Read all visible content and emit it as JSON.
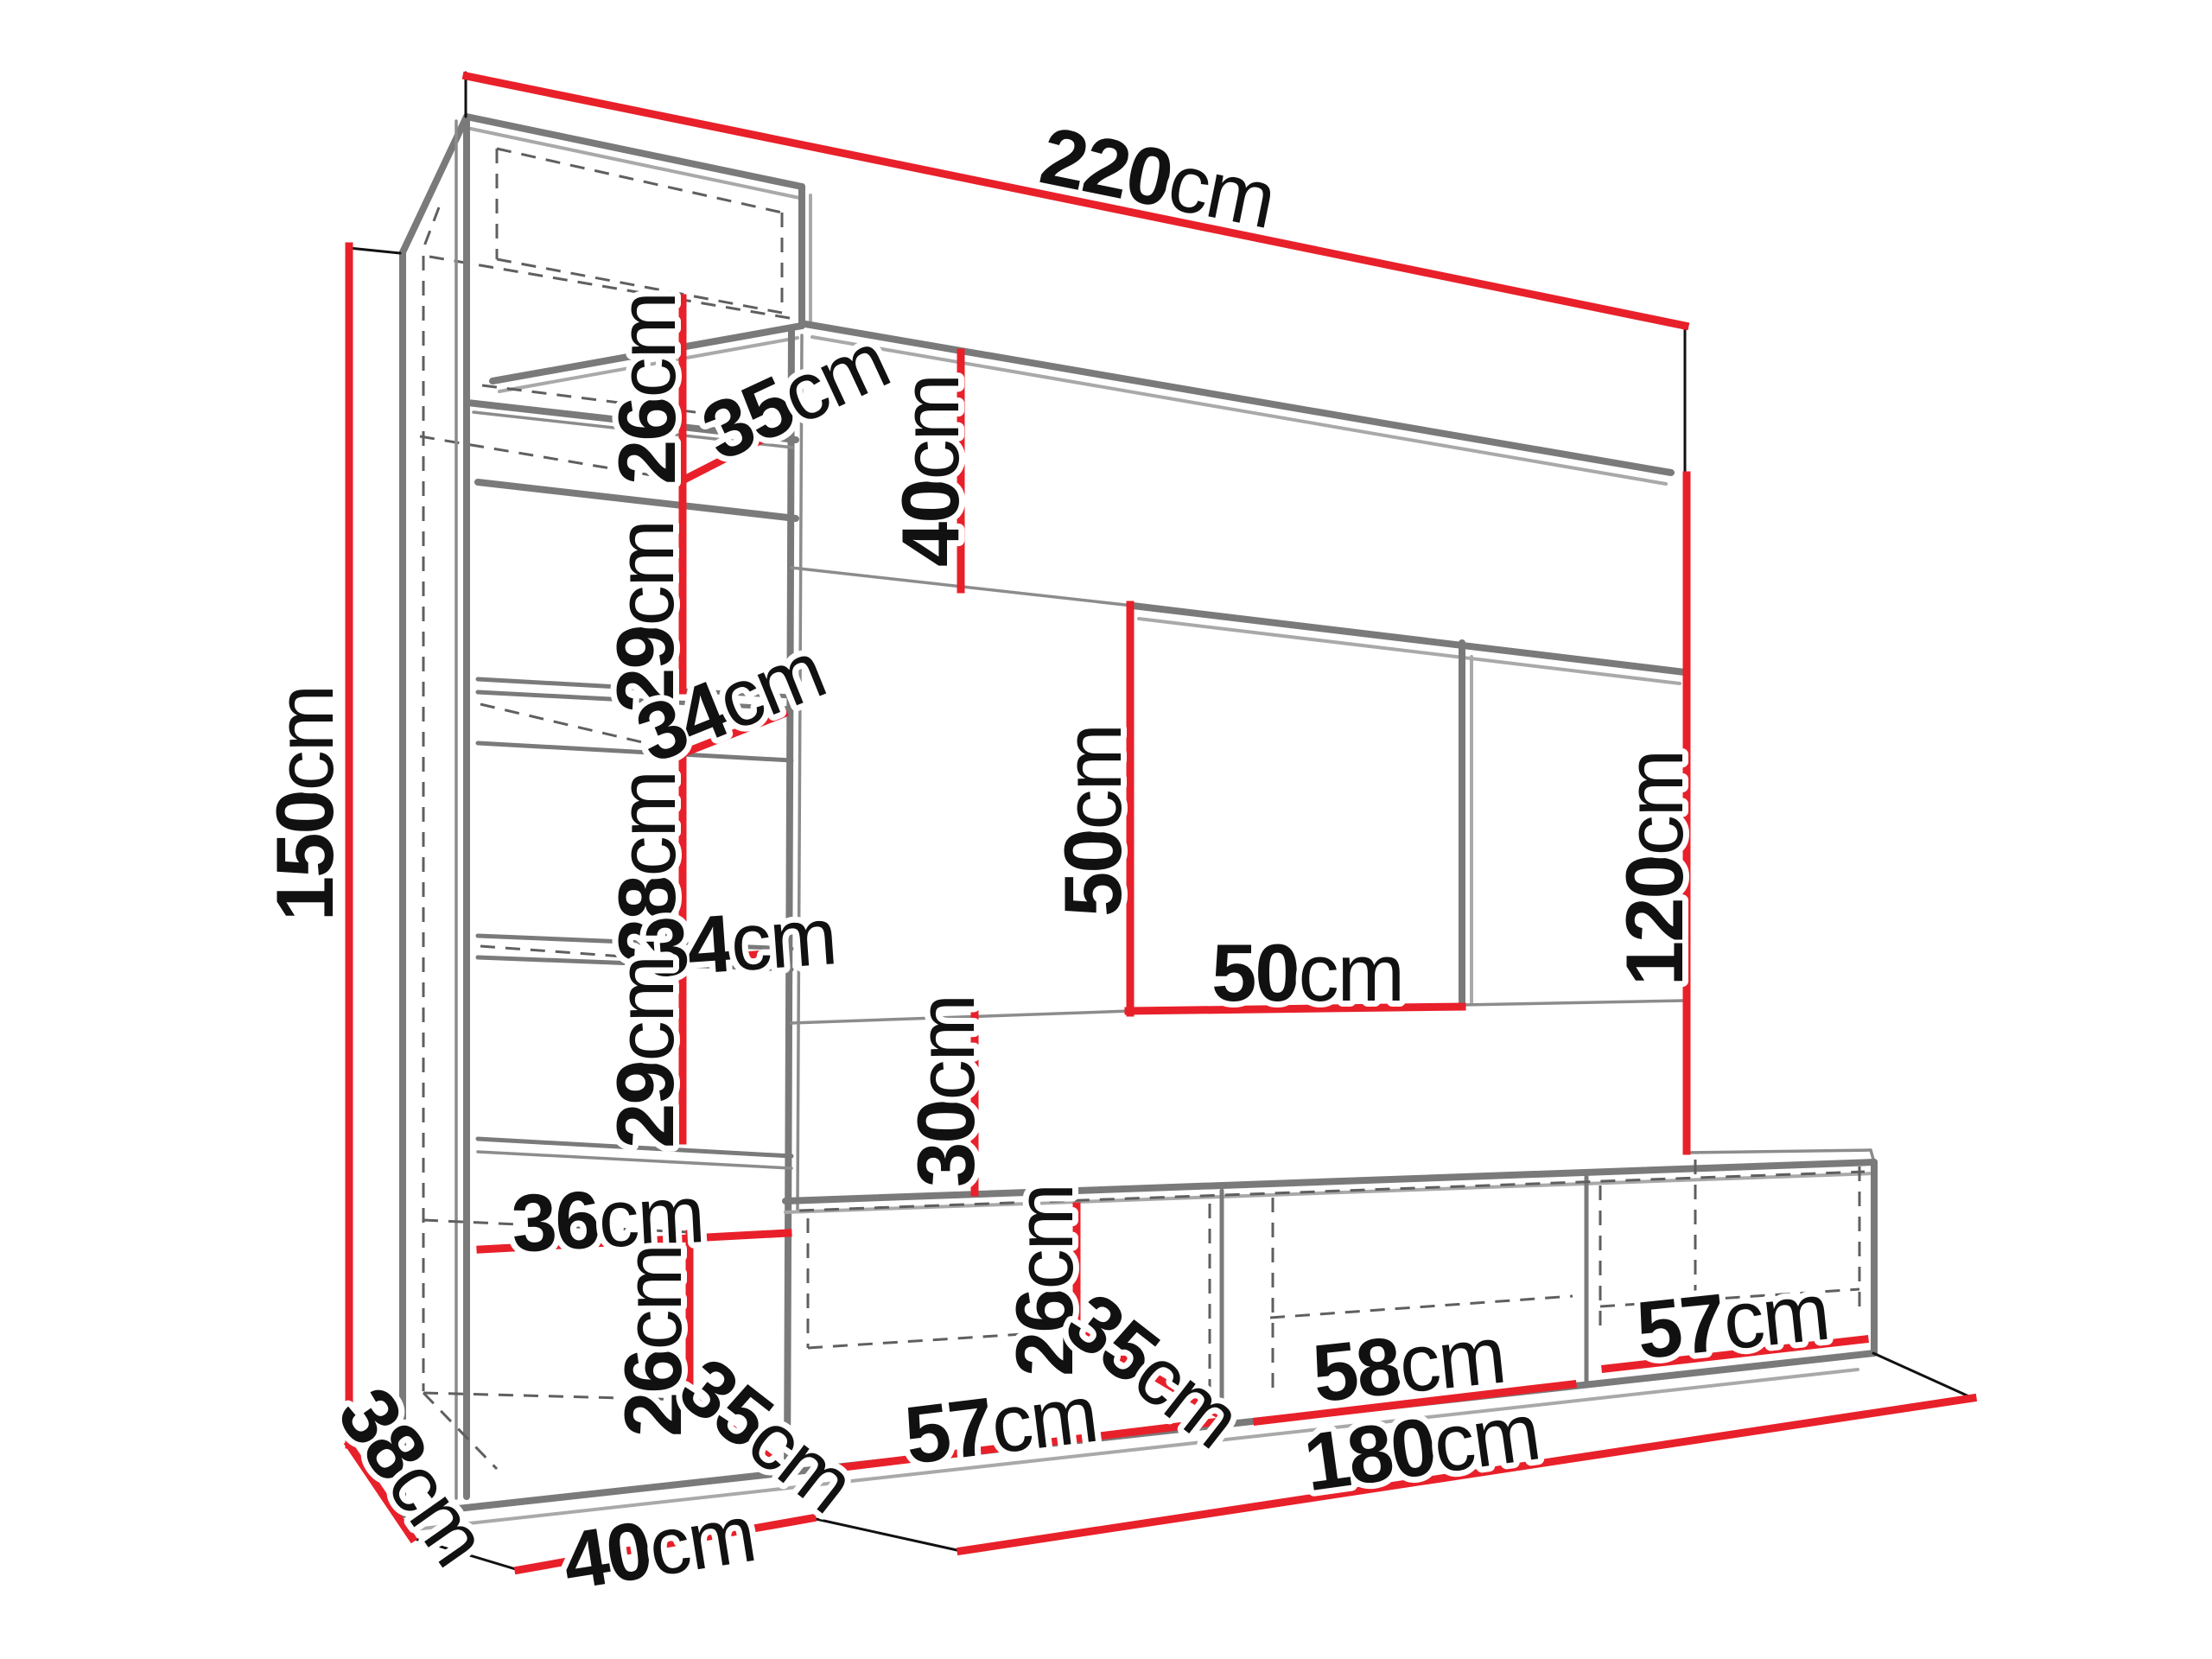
{
  "diagram": {
    "title": "Wall unit furniture dimension drawing",
    "unit": "cm",
    "style": {
      "background": "#ffffff",
      "dimension_line_color": "#e8202a",
      "outline_color": "#7a7a7a",
      "hidden_edge_color": "#5f5f5f",
      "text_color": "#111111"
    },
    "labels": [
      {
        "id": "width-overall",
        "value": "220",
        "unit": "cm"
      },
      {
        "id": "height-left",
        "value": "150",
        "unit": "cm"
      },
      {
        "id": "top-cabinet-height",
        "value": "26",
        "unit": "cm"
      },
      {
        "id": "top-cabinet-depth",
        "value": "35",
        "unit": "cm"
      },
      {
        "id": "gap-under-top-panel",
        "value": "40",
        "unit": "cm"
      },
      {
        "id": "shelf-space-upper",
        "value": "29",
        "unit": "cm"
      },
      {
        "id": "shelf-depth-upper",
        "value": "34",
        "unit": "cm"
      },
      {
        "id": "shelf-space-middle",
        "value": "28",
        "unit": "cm"
      },
      {
        "id": "shelf-depth-lower",
        "value": "34",
        "unit": "cm"
      },
      {
        "id": "niche-height",
        "value": "50",
        "unit": "cm"
      },
      {
        "id": "niche-width",
        "value": "50",
        "unit": "cm"
      },
      {
        "id": "height-right",
        "value": "120",
        "unit": "cm"
      },
      {
        "id": "shelf-space-lower",
        "value": "29",
        "unit": "cm"
      },
      {
        "id": "gap-above-tv-stand",
        "value": "30",
        "unit": "cm"
      },
      {
        "id": "bottom-cabinet-width",
        "value": "36",
        "unit": "cm"
      },
      {
        "id": "bottom-cabinet-height",
        "value": "26",
        "unit": "cm"
      },
      {
        "id": "bottom-cabinet-depth",
        "value": "35",
        "unit": "cm"
      },
      {
        "id": "tv-compartment-height",
        "value": "26",
        "unit": "cm"
      },
      {
        "id": "tv-compartment-depth",
        "value": "35",
        "unit": "cm"
      },
      {
        "id": "tv-compartment-left-width",
        "value": "57",
        "unit": "cm"
      },
      {
        "id": "tv-compartment-mid-width",
        "value": "58",
        "unit": "cm"
      },
      {
        "id": "tv-compartment-right-width",
        "value": "57",
        "unit": "cm"
      },
      {
        "id": "base-side-depth",
        "value": "38",
        "unit": "cm"
      },
      {
        "id": "base-front-depth",
        "value": "40",
        "unit": "cm"
      },
      {
        "id": "tv-stand-width",
        "value": "180",
        "unit": "cm"
      }
    ]
  }
}
